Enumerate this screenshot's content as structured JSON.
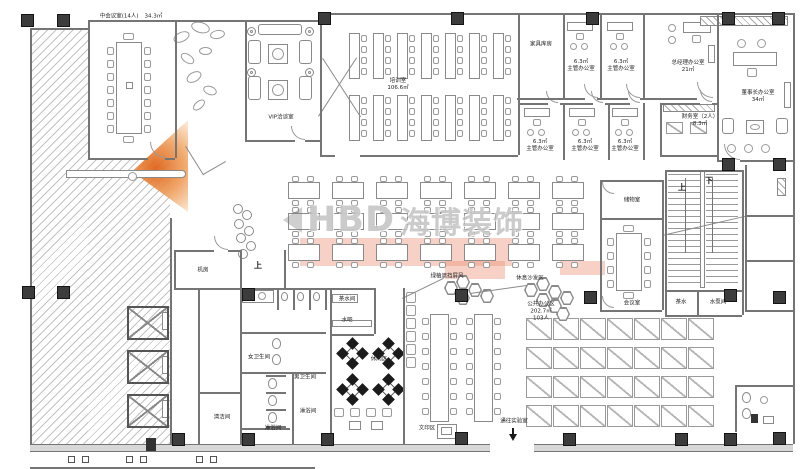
{
  "watermark": {
    "brand": "HBD",
    "brand_cn": "海博装饰"
  },
  "stairs": {
    "up_label": "上",
    "down_label": "下"
  },
  "lobby": {
    "up_label": "上"
  },
  "rooms": {
    "mid_meeting": {
      "label": "中会议室(14人)",
      "area": "34.3㎡"
    },
    "vip": {
      "label": "VIP洽谈室"
    },
    "training": {
      "label": "培训室",
      "area": "106.6㎡"
    },
    "furniture_storage": {
      "label": "家具库房"
    },
    "supervisor": {
      "area": "6.3㎡",
      "label": "主管办公室"
    },
    "general_manager": {
      "label": "总经理办公室",
      "area": "21㎡"
    },
    "chairman": {
      "label": "董事长办公室",
      "area": "34㎡"
    },
    "finance": {
      "label": "财务室（2人）",
      "area": "8.3㎡"
    },
    "storage": {
      "label": "储物室"
    },
    "meeting": {
      "label": "会议室"
    },
    "tea": {
      "label": "茶水"
    },
    "pump": {
      "label": "水泵间"
    },
    "machine_room": {
      "label": "机房"
    },
    "pantry": {
      "label": "茶水间"
    },
    "water_bar": {
      "label": "水吧"
    },
    "leisure": {
      "label": "休闲区"
    },
    "screen": {
      "label": "绿植遮挡屏风"
    },
    "sofa_area": {
      "label": "休息沙发区"
    },
    "open_office": {
      "label": "公共办公区",
      "area": "202.7㎡",
      "capacity": "103人"
    },
    "print_area": {
      "label": "文印区"
    },
    "to_lab": {
      "label": "通往实验室"
    },
    "women_wc": {
      "label": "女卫生间"
    },
    "men_wc": {
      "label": "男卫生间"
    },
    "shower": {
      "label": "淋浴间"
    },
    "cleaning": {
      "label": "清洁间"
    }
  }
}
